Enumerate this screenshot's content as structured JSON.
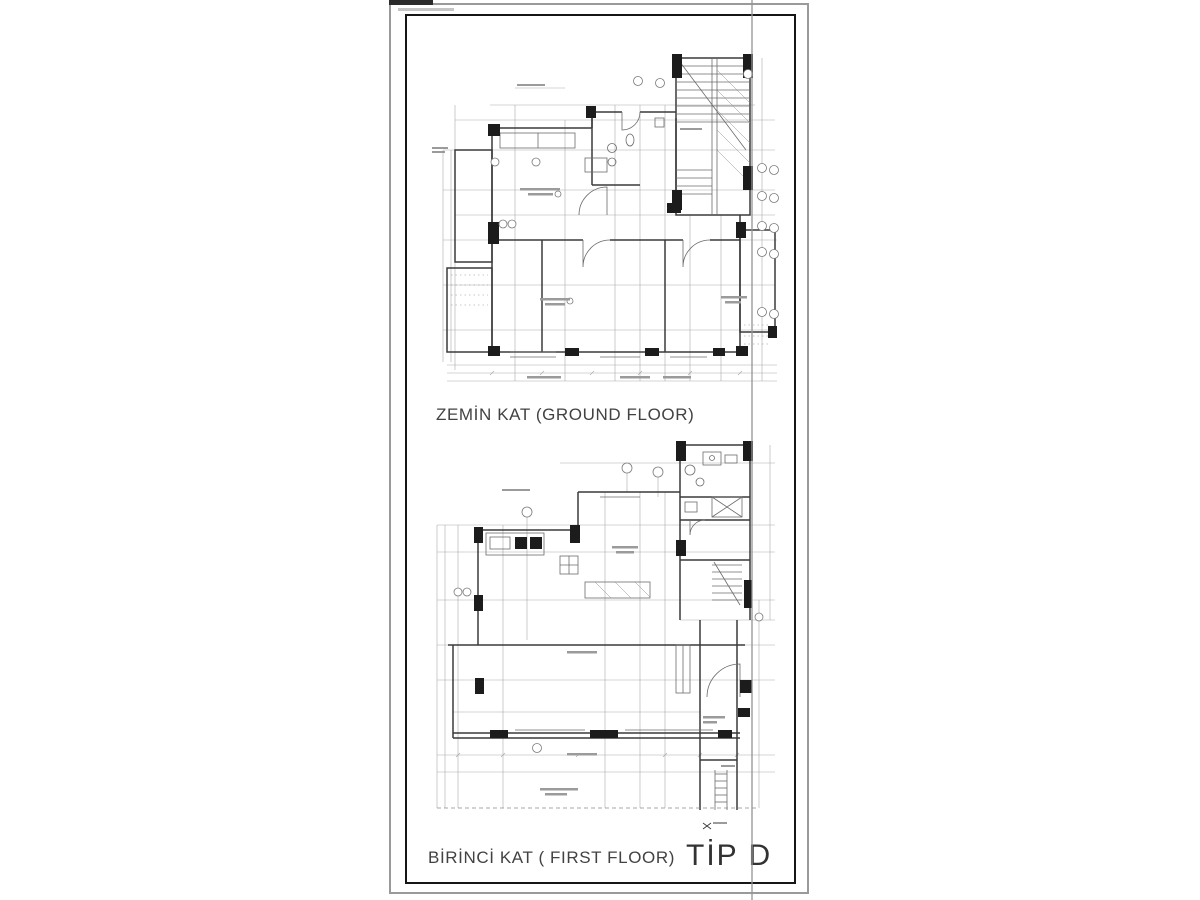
{
  "sheet": {
    "paper_color": "#ffffff",
    "outer_border_color": "#9a9a9a",
    "inner_border_color": "#161616",
    "fold_line_color": "#949494",
    "ink_color": "#3a3a3a",
    "dim_line_color": "#a9a9a9"
  },
  "plans": {
    "ground": {
      "caption": "ZEMİN KAT (GROUND FLOOR)"
    },
    "first": {
      "caption": "BİRİNCİ KAT ( FIRST FLOOR)"
    },
    "type_label": "TİP D"
  }
}
